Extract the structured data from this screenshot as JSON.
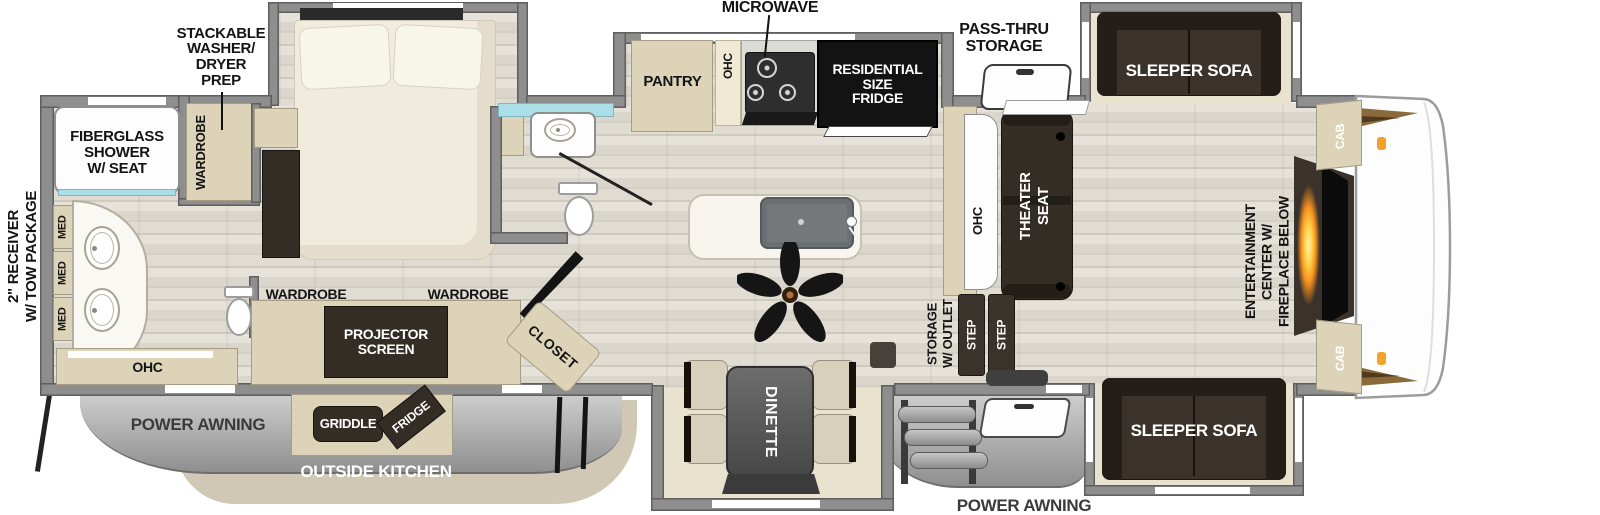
{
  "colors": {
    "wall": "#8e8e8e",
    "wall_edge": "#5f5f5f",
    "floor_a": "#e6e2d9",
    "floor_b": "#d4cfc4",
    "cabinet": "#dcd3b9",
    "cabinet_edge": "#a59c83",
    "dark_furniture": "#342d26",
    "slide_floor": "#e9e2cf",
    "awning_light": "#cecece",
    "awning_dark": "#8f8f8f",
    "glass": "#abdfe8",
    "flame": "#f6921e",
    "marker": "#f0a22c",
    "text_dark": "#141414",
    "text_white": "#ffffff"
  },
  "labels": {
    "receiver": "2\" RECEIVER\nW/ TOW PACKAGE",
    "washer_prep": "STACKABLE\nWASHER/\nDRYER\nPREP",
    "fiberglass_shower": "FIBERGLASS\nSHOWER\nW/ SEAT",
    "wardrobe": "WARDROBE",
    "med": "MED",
    "ohc": "OHC",
    "microwave": "MICROWAVE",
    "pantry": "PANTRY",
    "residential_fridge": "RESIDENTIAL\nSIZE\nFRIDGE",
    "pass_thru_storage": "PASS-THRU\nSTORAGE",
    "sleeper_sofa": "SLEEPER SOFA",
    "theater_seat": "THEATER\nSEAT",
    "entertainment_center": "ENTERTAINMENT\nCENTER W/\nFIREPLACE BELOW",
    "cab": "CAB",
    "storage_outlet": "STORAGE\nW/ OUTLET",
    "step": "STEP",
    "dinette": "DINETTE",
    "closet": "CLOSET",
    "projector_screen": "PROJECTOR\nSCREEN",
    "griddle": "GRIDDLE",
    "outside_fridge": "FRIDGE",
    "power_awning": "POWER AWNING",
    "outside_kitchen": "OUTSIDE KITCHEN"
  }
}
